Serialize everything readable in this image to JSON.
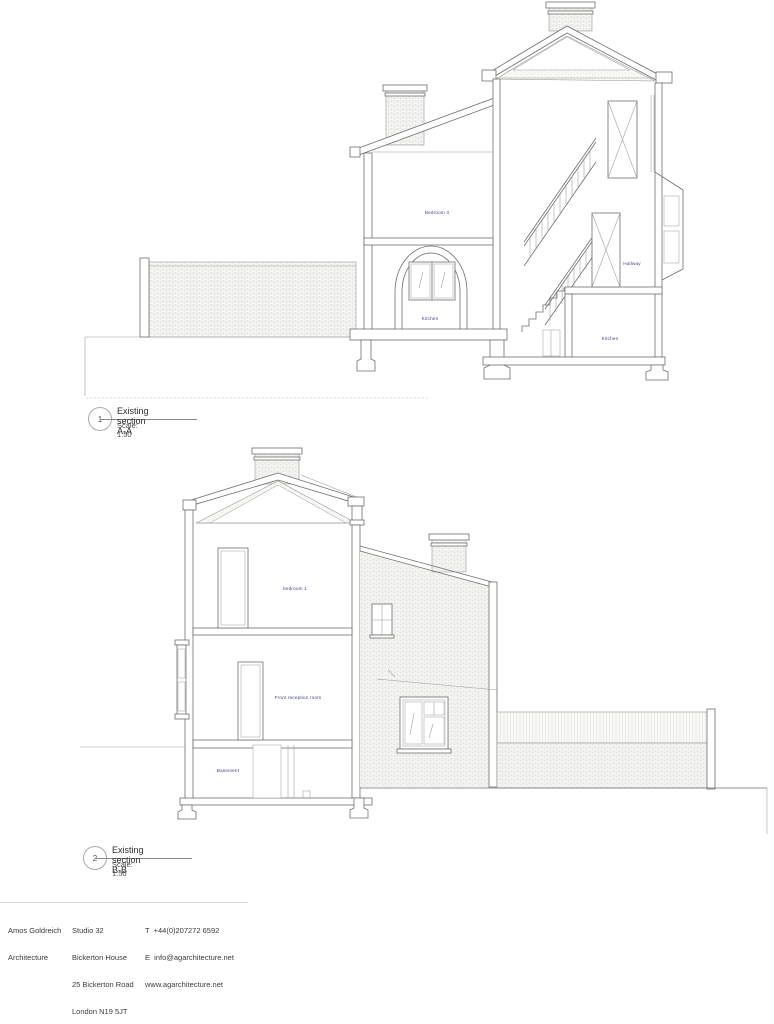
{
  "colors": {
    "background": "#ffffff",
    "line": "#6f6f6f",
    "line_light": "#9a9a9a",
    "hatch": "#d7d7d2",
    "label_blue": "#3d3d8f",
    "text": "#3b3b3b"
  },
  "drawing1": {
    "number": "1",
    "title": "Existing section A-A",
    "scale": "Scale: 1:50",
    "labels": {
      "bedroom3": "Bedroom 3",
      "kitchen": "Kitchen",
      "hallway": "Hallway",
      "kitchen_lower": "Kitchen"
    }
  },
  "drawing2": {
    "number": "2",
    "title": "Existing section B-B",
    "scale": "Scale: 1:50",
    "labels": {
      "bedroom1": "bedroom 1",
      "front_reception": "Front reception room",
      "basement": "Basement"
    }
  },
  "footer": {
    "firm": [
      "Amos Goldreich",
      "Architecture"
    ],
    "address": [
      "Studio 32",
      "Bickerton House",
      "25 Bickerton Road",
      "London N19 5JT"
    ],
    "contact": [
      "T  +44(0)207272 6592",
      "E  info@agarchitecture.net",
      "www.agarchitecture.net"
    ]
  }
}
